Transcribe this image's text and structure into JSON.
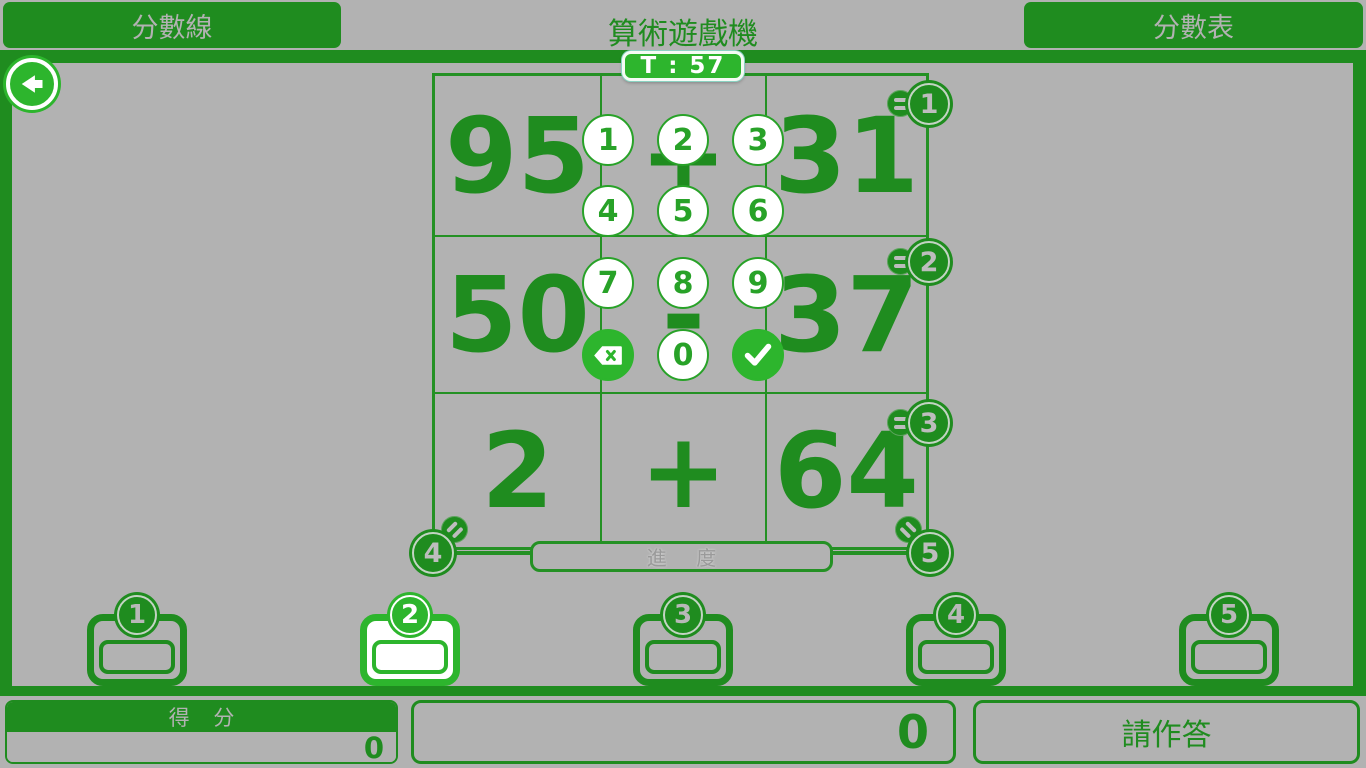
{
  "top_bar": {
    "left_button_label": "分數線",
    "title": "算術遊戲機",
    "right_button_label": "分數表"
  },
  "timer": {
    "text": "T : 57"
  },
  "grid": {
    "problems": [
      {
        "left": "95",
        "operator": "+",
        "right": "31"
      },
      {
        "left": "50",
        "operator": "-",
        "right": "37"
      },
      {
        "left": "2",
        "operator": "+",
        "right": "64"
      }
    ],
    "row_badges": [
      "1",
      "2",
      "3"
    ],
    "corner_badges": {
      "left": "4",
      "right": "5"
    },
    "progress_label": "進 度"
  },
  "keypad": {
    "digits": [
      "1",
      "2",
      "3",
      "4",
      "5",
      "6",
      "7",
      "8",
      "9"
    ],
    "zero": "0",
    "icons": {
      "backspace": "backspace-icon",
      "confirm": "check-icon"
    }
  },
  "answer_slots": [
    {
      "number": "1",
      "value": "",
      "selected": false
    },
    {
      "number": "2",
      "value": "",
      "selected": true
    },
    {
      "number": "3",
      "value": "",
      "selected": false
    },
    {
      "number": "4",
      "value": "",
      "selected": false
    },
    {
      "number": "5",
      "value": "",
      "selected": false
    }
  ],
  "bottom_bar": {
    "score_label": "得 分",
    "score_value": "0",
    "input_display": "0",
    "action_button_label": "請作答"
  },
  "icons": {
    "back": "arrow-left-icon"
  },
  "colors": {
    "dark_green": "#1f8c1f",
    "bright_green": "#2db52d",
    "keypad_green": "#28a228",
    "grid_line_green": "#249124",
    "background_gray": "#b2b2b2",
    "silver_text": "#b2b2b2",
    "white": "#ffffff"
  }
}
